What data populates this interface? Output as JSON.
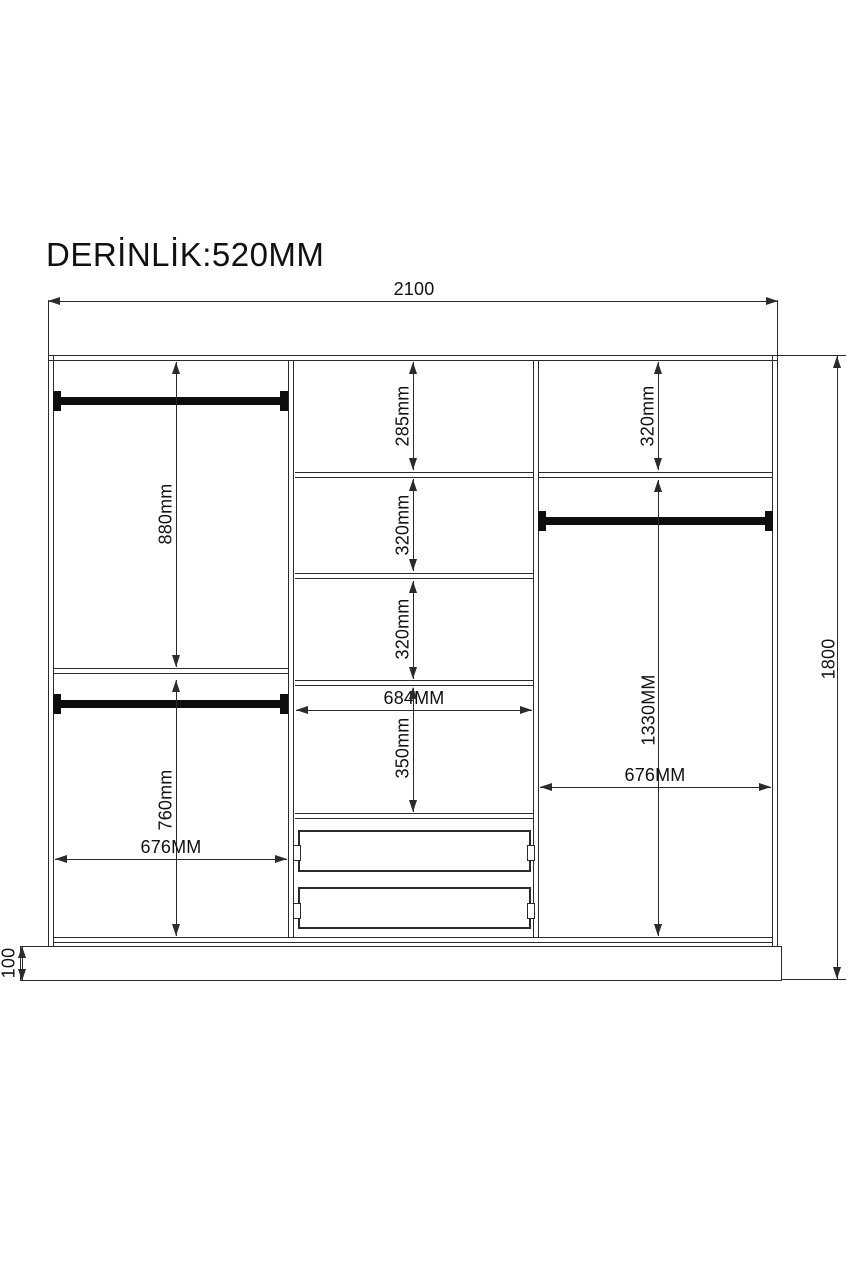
{
  "title": "DERİNLİK:520MM",
  "colors": {
    "line": "#2b2b2b",
    "rod": "#0e0e0e",
    "background": "#ffffff"
  },
  "dimensions": {
    "overall_width": "2100",
    "overall_height": "1800",
    "base_height": "100",
    "left_section": {
      "upper_height": "880mm",
      "lower_height": "760mm",
      "width": "676MM"
    },
    "middle_section": {
      "compartment1_height": "285mm",
      "compartment2_height": "320mm",
      "compartment3_height": "320mm",
      "width": "684MM",
      "compartment4_height": "350mm"
    },
    "right_section": {
      "top_height": "320mm",
      "hanging_height": "1330MM",
      "width": "676MM"
    }
  }
}
